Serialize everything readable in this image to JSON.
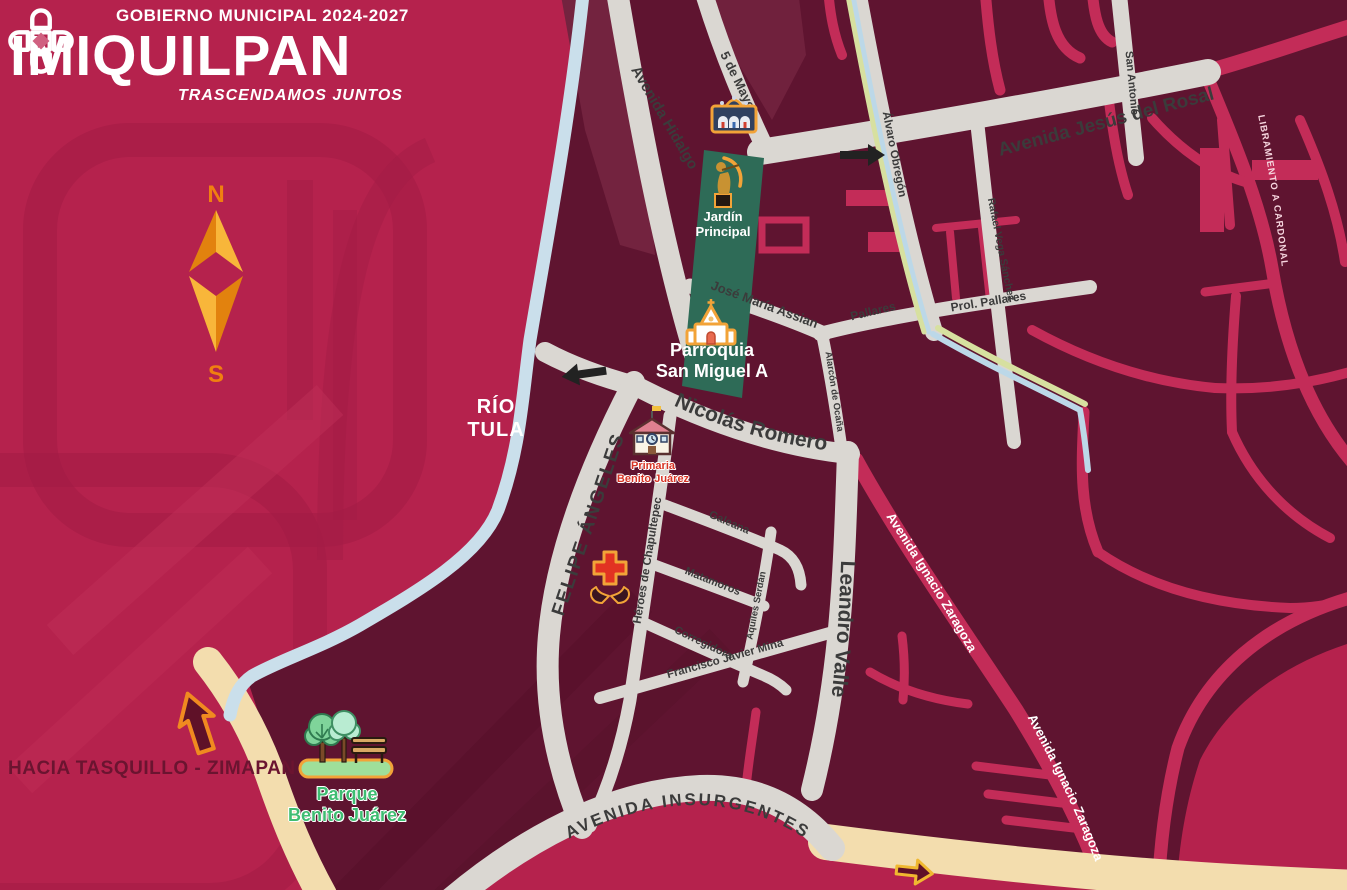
{
  "header": {
    "line1": "GOBIERNO MUNICIPAL 2024-2027",
    "logo_i": "I",
    "logo_name": "MIQUILPAN",
    "tagline": "TRASCENDAMOS JUNTOS"
  },
  "compass": {
    "north": "N",
    "south": "S"
  },
  "labels": {
    "rio_line1": "RÍO",
    "rio_line2": "TULA",
    "hacia": "HACIA TASQUILLO - ZIMAPAN"
  },
  "streets": {
    "hidalgo": "Avenida Hidalgo",
    "cinco_de_mayo": "5 de Mayo",
    "jesus_del_rosal": "Avenida Jesús del Rosal",
    "san_antonio": "San Antonio",
    "alvaro_obregon": "Álvaro Obregón",
    "rafael_vega": "Rafael Vega Sánchez",
    "prol_pallares": "Prol. Pallares",
    "pallares": "Pallares",
    "jose_maria_assian": "José María Assian",
    "alarcon_de_ocana": "Alarcón de Ocaña",
    "nicolas_romero": "Nicolás Romero",
    "felipe_angeles": "FELIPE ÁNGELES",
    "heroes_chapultepec": "Héroes de Chapultepec",
    "galeana": "Galeana",
    "matamoros": "Matamoros",
    "corregidora": "Corregidora",
    "aquiles_serdan": "Aquiles Serdán",
    "francisco_javier_mina": "Francisco Javier Mina",
    "leandro_valle": "Leandro Valle",
    "ignacio_zaragoza": "Avenida Ignacio Zaragoza",
    "insurgentes": "AVENIDA INSURGENTES",
    "libramiento": "LIBRAMIENTO A CARDONAL"
  },
  "pois": {
    "jardin": {
      "line1": "Jardín",
      "line2": "Principal"
    },
    "parroquia": {
      "line1": "Parroquia",
      "line2": "San Miguel A"
    },
    "primaria": {
      "line1": "Primaria",
      "line2": "Benito Juárez"
    },
    "parque": {
      "line1": "Parque",
      "line2": "Benito Juárez"
    }
  },
  "colors": {
    "outside_crimson": "#b5224d",
    "city_maroon": "#5f1430",
    "road_gray": "#dad7d2",
    "road_pink": "#c32c58",
    "road_beige": "#f3ddae",
    "river_blue": "#cadfeb",
    "canal_green": "#d7e0a0",
    "park_green": "#2e6b57",
    "accent_orange": "#f2a338",
    "label_dark": "#3b3b3b"
  }
}
